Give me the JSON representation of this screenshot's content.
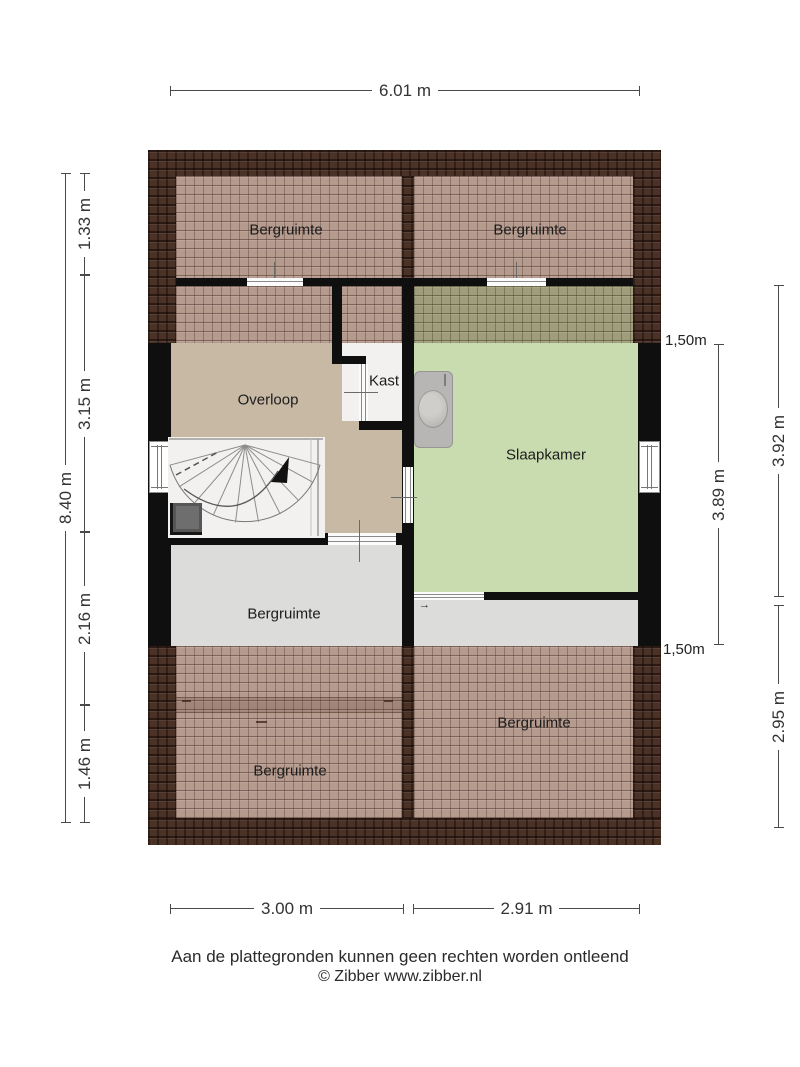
{
  "rooms": {
    "bergruimte_top_left": "Bergruimte",
    "bergruimte_top_right": "Bergruimte",
    "overloop": "Overloop",
    "kast": "Kast",
    "slaapkamer": "Slaapkamer",
    "bergruimte_mid": "Bergruimte",
    "bergruimte_bottom_left": "Bergruimte",
    "bergruimte_bottom_right": "Bergruimte"
  },
  "dimensions": {
    "top_width": "6.01 m",
    "left_total": "8.40 m",
    "left_seg_1": "1.33 m",
    "left_seg_2": "3.15 m",
    "left_seg_3": "2.16 m",
    "left_seg_4": "1.46 m",
    "right_outer_seg_1": "3.92 m",
    "right_outer_seg_2": "2.95 m",
    "right_inner": "3.89 m",
    "knee_height_top": "1,50m",
    "knee_height_bottom": "1,50m",
    "bottom_left_width": "3.00 m",
    "bottom_right_width": "2.91 m"
  },
  "symbols": {
    "stair_direction_arrow": "up",
    "door_swing_arrow": "→"
  },
  "footer": {
    "disclaimer": "Aan de plattegronden kunnen geen rechten worden ontleend",
    "copyright": "© Zibber www.zibber.nl"
  },
  "colors": {
    "roof_dark": "#4a3226",
    "roof_hatch": "#b59a8e",
    "roof_hatch_olive": "#a09d7c",
    "floor_overloop": "#c7b9a4",
    "floor_slaapkamer": "#c9dcb0",
    "floor_bergruimte": "#dcdcdb",
    "floor_white": "#f2f1ef",
    "wall": "#0f0f0f"
  }
}
